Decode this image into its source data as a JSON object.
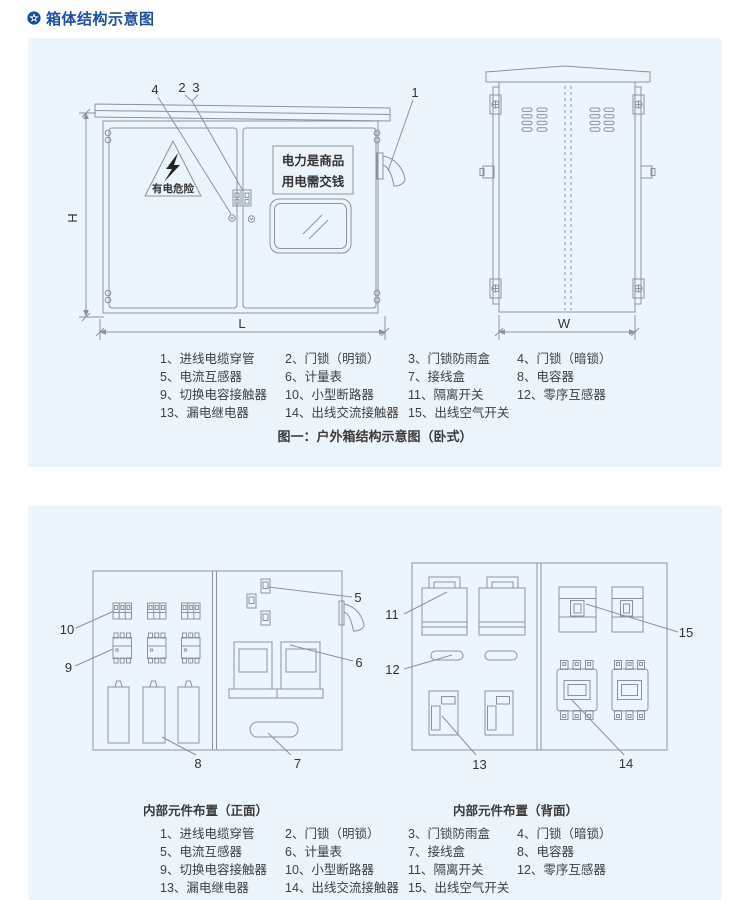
{
  "header": {
    "title": "箱体结构示意图",
    "icon": "star-badge"
  },
  "figure1": {
    "caption": "图一：户外箱结构示意图（卧式）",
    "front_view": {
      "warning_text": "有电危险",
      "sign_line1": "电力是商品",
      "sign_line2": "用电需交钱",
      "dim_h": "H",
      "dim_l": "L",
      "callout_1": "1",
      "callout_2": "2",
      "callout_3": "3",
      "callout_4": "4"
    },
    "side_view": {
      "dim_w": "W"
    }
  },
  "parts_list": [
    "1、进线电缆穿管",
    "2、门锁（明锁）",
    "3、门锁防雨盒",
    "4、门锁（暗锁）",
    "5、电流互感器",
    "6、计量表",
    "7、接线盒",
    "8、电容器",
    "9、切换电容接触器",
    "10、小型断路器",
    "11、隔离开关",
    "12、零序互感器",
    "13、漏电继电器",
    "14、出线交流接触器",
    "15、出线空气开关"
  ],
  "figure2": {
    "front_layout": {
      "caption": "内部元件布置（正面）",
      "callout_5": "5",
      "callout_6": "6",
      "callout_7": "7",
      "callout_8": "8",
      "callout_9": "9",
      "callout_10": "10"
    },
    "back_layout": {
      "caption": "内部元件布置（背面）",
      "callout_11": "11",
      "callout_12": "12",
      "callout_13": "13",
      "callout_14": "14",
      "callout_15": "15"
    }
  },
  "colors": {
    "panel_bg": "#edf5fc",
    "header_blue": "#1c4fa4",
    "line_gray": "#8b929b",
    "text_dark": "#3e3e3e"
  }
}
